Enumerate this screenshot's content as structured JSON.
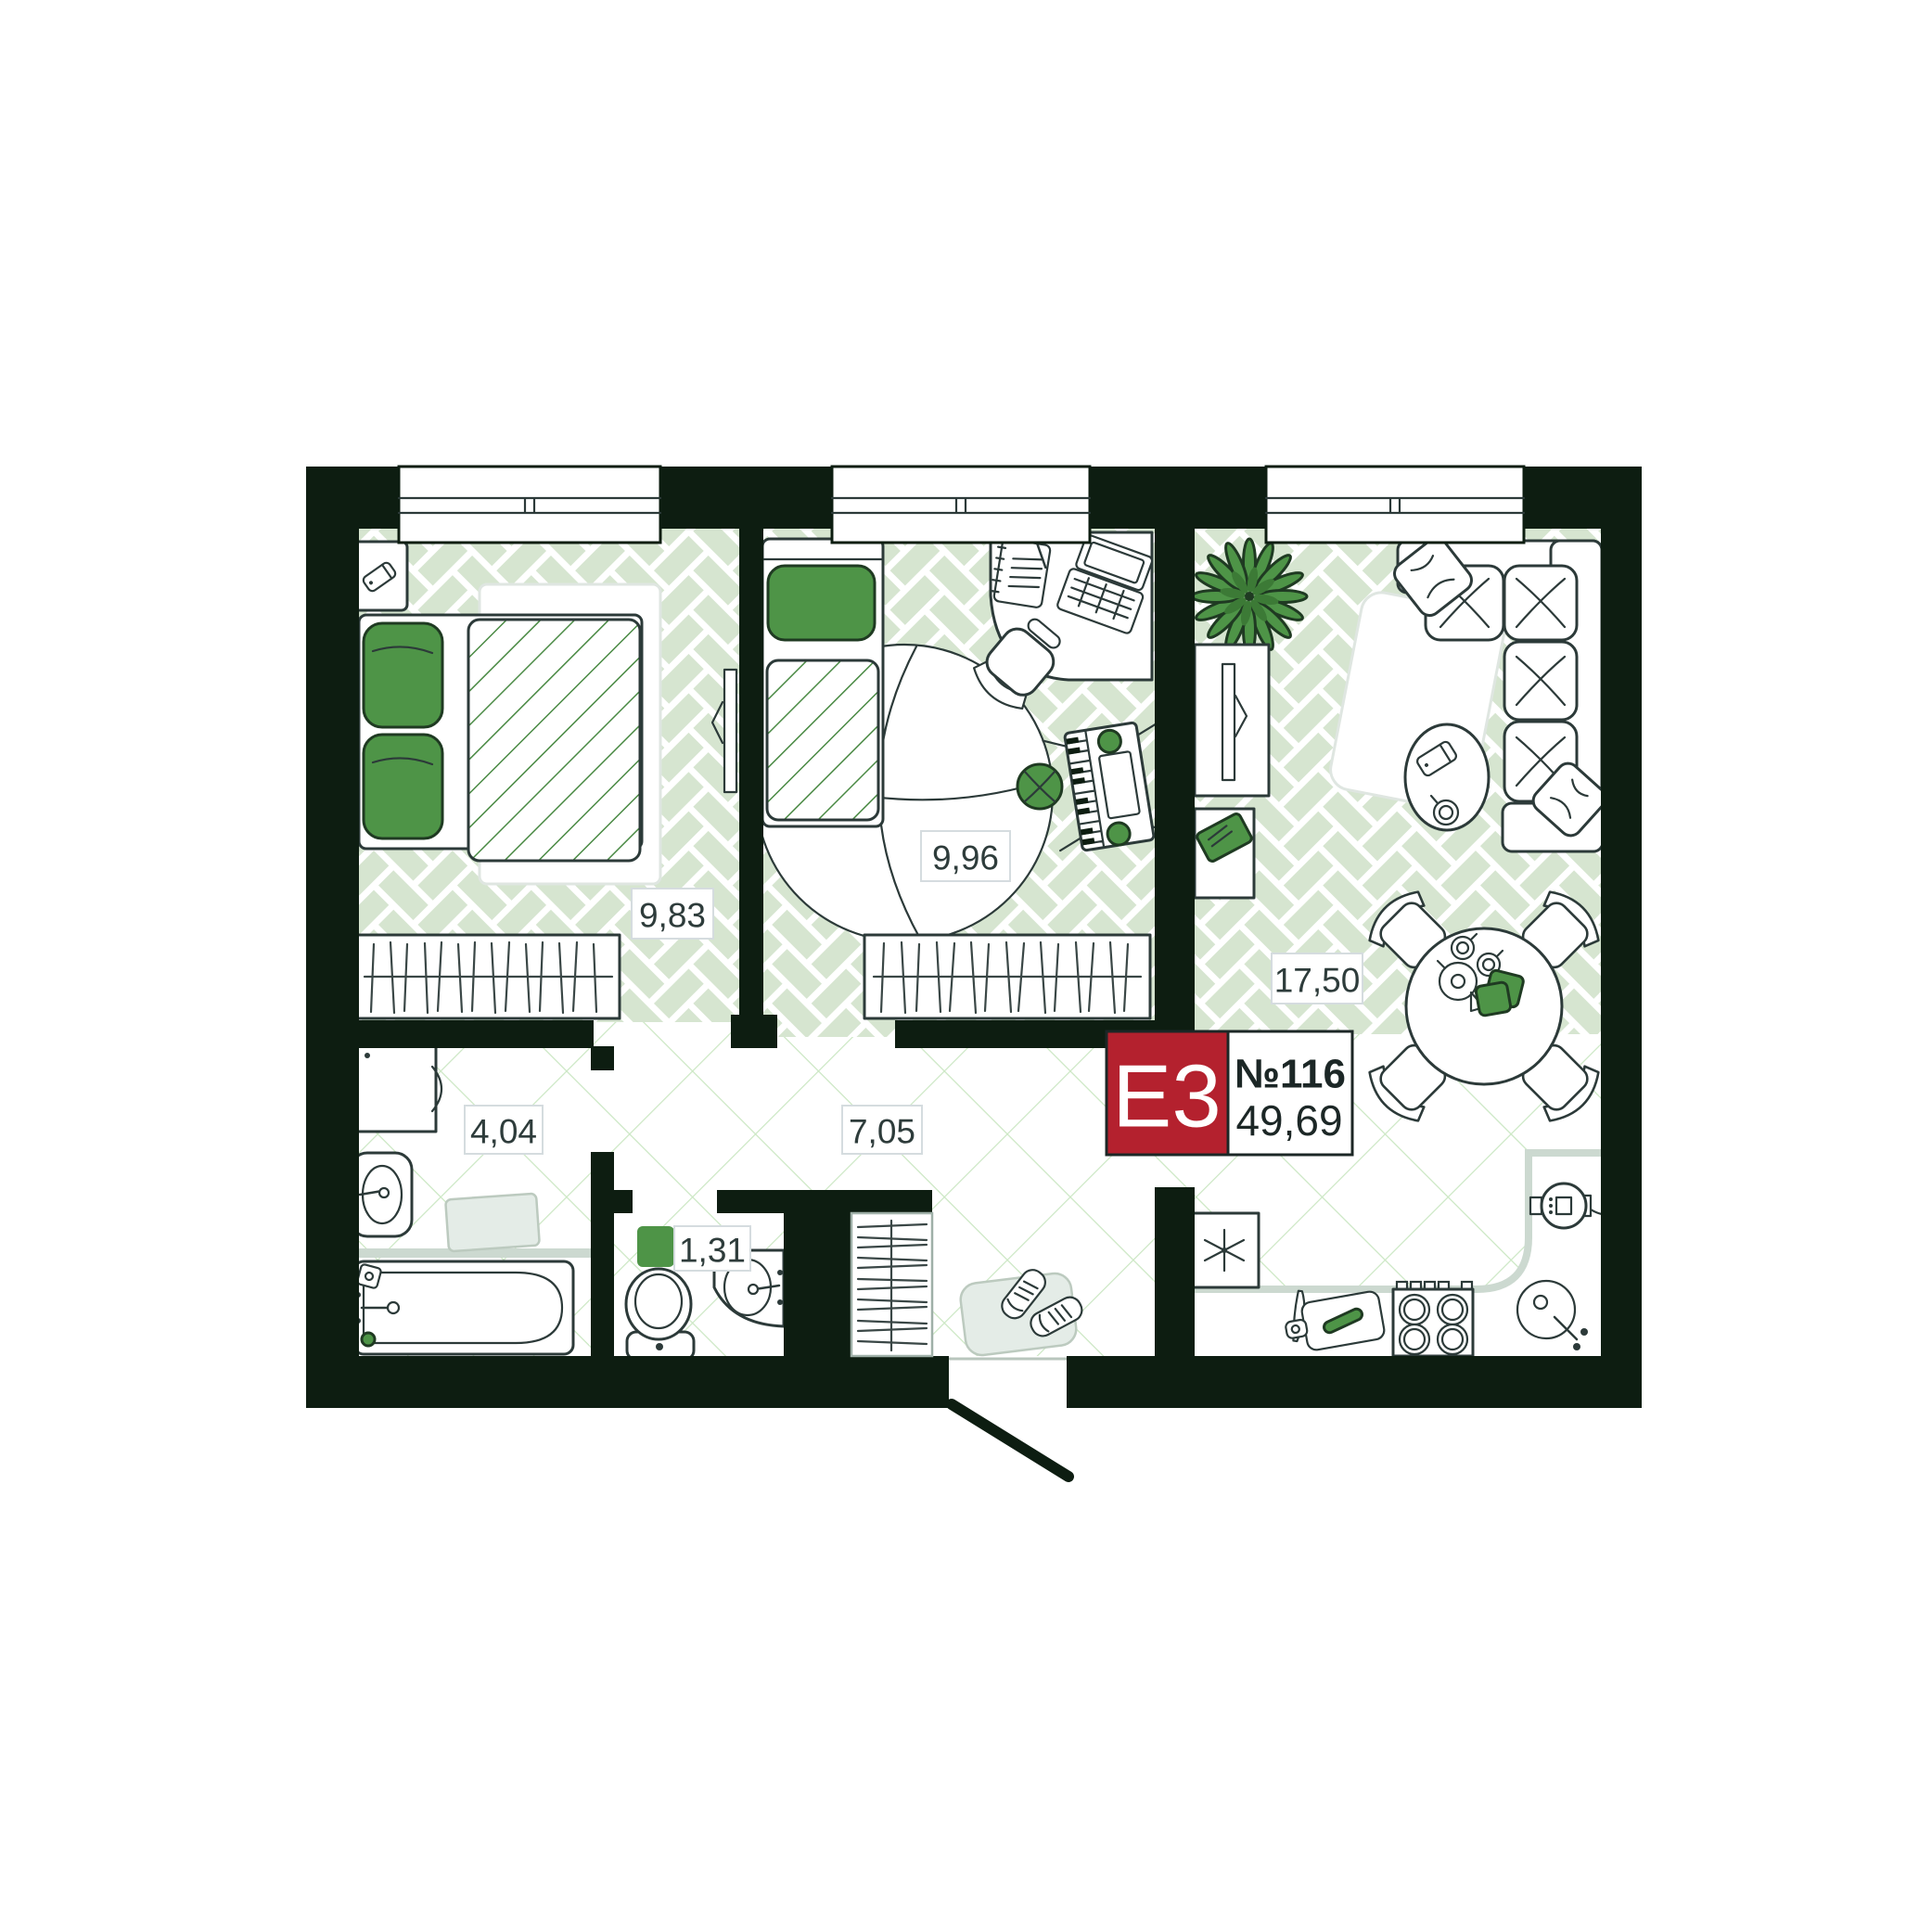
{
  "unit_badge": {
    "type": "E3",
    "number": "№116",
    "area_total": "49,69"
  },
  "rooms": [
    {
      "name": "bedroom-1",
      "area": "9,83"
    },
    {
      "name": "bedroom-2",
      "area": "9,96"
    },
    {
      "name": "living-room-kitchen",
      "area": "17,50"
    },
    {
      "name": "bathroom",
      "area": "4,04"
    },
    {
      "name": "hallway",
      "area": "7,05"
    },
    {
      "name": "wc",
      "area": "1,31"
    }
  ],
  "colors": {
    "wall": "#0d1d11",
    "tile_green": "#d6e5d0",
    "grid_green": "#cbe7c3",
    "accent_green": "#4e9447",
    "stripe_green": "#4a8a44",
    "badge_red": "#b4212e",
    "text": "#2e3c3b",
    "outline": "#2c3a39"
  },
  "icons": [
    "double-bed",
    "single-bed",
    "wardrobe",
    "closet",
    "tv",
    "sofa",
    "coffee-table",
    "dining-table",
    "dining-chair",
    "plant",
    "desk",
    "laptop",
    "notebook",
    "office-chair",
    "piano-keyboard",
    "pouf",
    "round-rug",
    "rug",
    "washing-machine",
    "bathroom-sink",
    "bathtub",
    "bath-mat",
    "toilet",
    "wc-sink",
    "fridge",
    "stove",
    "kitchen-sink",
    "kettle",
    "cutting-board",
    "knife",
    "doormat",
    "sneakers",
    "entrance-door",
    "window",
    "phone",
    "nightstand",
    "teapot",
    "cup",
    "napkin",
    "book"
  ]
}
